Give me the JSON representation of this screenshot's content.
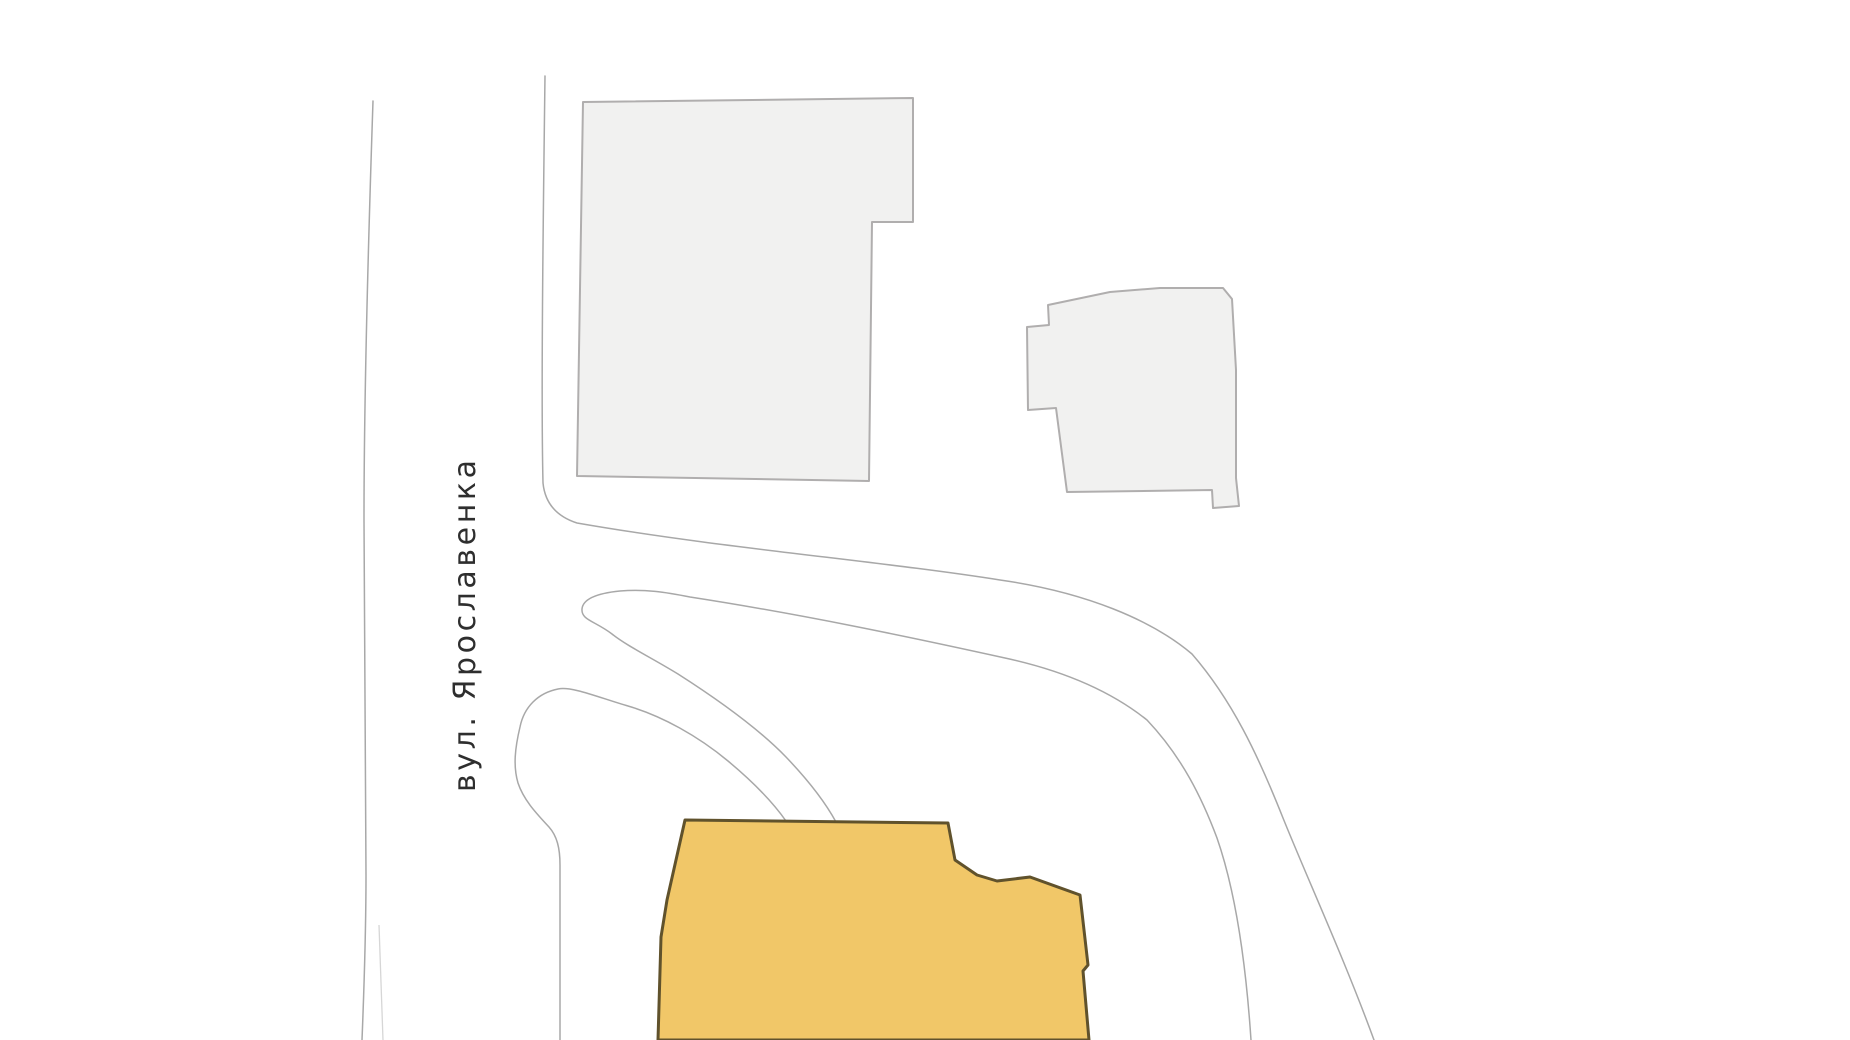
{
  "map": {
    "type": "vector-map-fragment",
    "street_label": "вул. Ярославенка",
    "features": {
      "street": "vertical street running along the left side, labeled",
      "building_large_gray": "large unlabeled building block, top left",
      "building_small_gray": "small unlabeled building block, top right of center",
      "building_highlighted": "selected / highlighted building at bottom center, cut off by viewport bottom",
      "roads": "thin outline road edges: street edge, bend to the east, two hairpin driveway loops ending at highlighted building, road corridor curving to bottom right"
    }
  },
  "colors": {
    "background": "#ffffff",
    "road_line": "#a8a8a8",
    "road_line_faint": "#c4c4c4",
    "building_fill": "#f1f1f0",
    "building_stroke": "#b0aeae",
    "highlight_fill": "#f1c768",
    "highlight_stroke": "#60522c",
    "label_color": "#2e2e2e"
  }
}
